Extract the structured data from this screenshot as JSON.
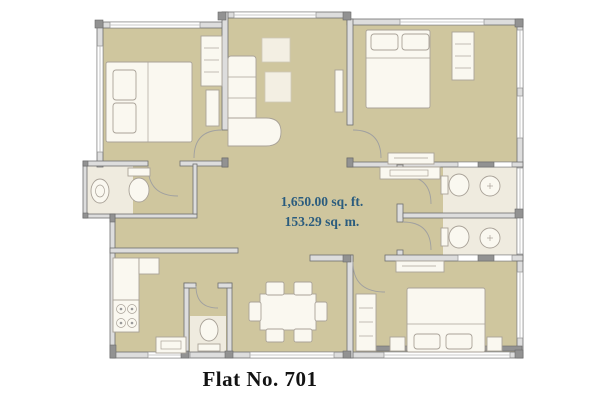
{
  "plan": {
    "area_sqft": "1,650.00 sq. ft.",
    "area_sqm": "153.29 sq. m.",
    "caption": "Flat No. 701"
  },
  "colors": {
    "page_bg": "#ffffff",
    "floor": "#cfc69e",
    "wall_fill": "#dddddd",
    "wall_stroke": "#6f6f6f",
    "wall_dark": "#929292",
    "window_fill": "#ffffff",
    "furniture_fill": "#faf8f0",
    "furniture_stroke": "#a9a298",
    "bath_floor": "#efebdf",
    "area_text": "#2b5c7e",
    "caption_text": "#131313"
  }
}
